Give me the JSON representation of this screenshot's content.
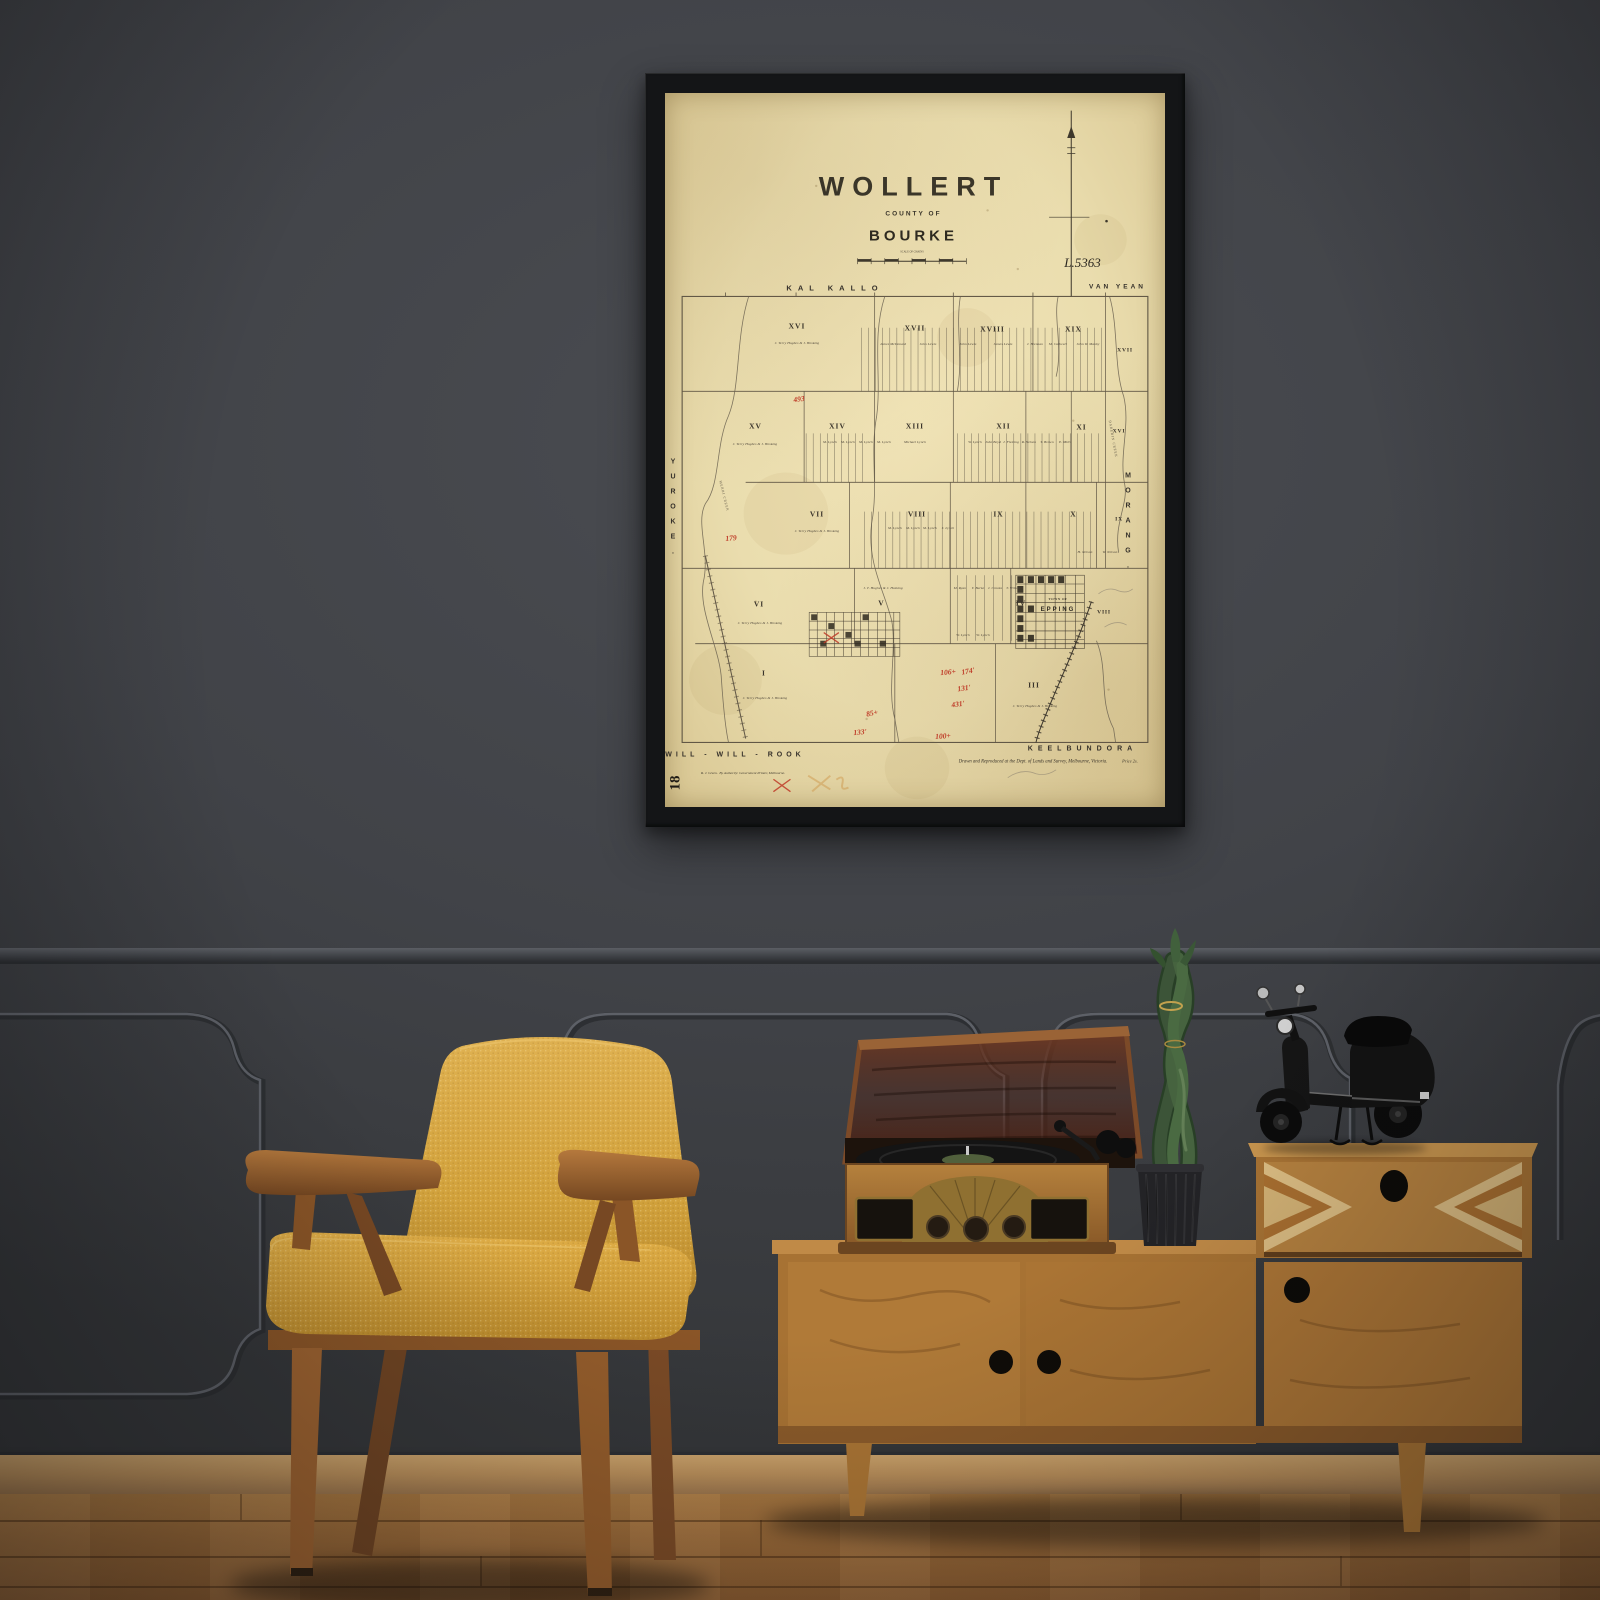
{
  "poster": {
    "title": "WOLLERT",
    "subtitle": "COUNTY OF",
    "county": "BOURKE",
    "scale_caption": "SCALE OF CHAINS",
    "plan_number": "L.5363",
    "corner_mark": "18",
    "credit": "Drawn and Reproduced at the Dept. of Lands and Survey, Melbourne, Victoria.",
    "price": "Price 2s.",
    "printer_name": "R. J. Green.",
    "printer_note": "By Authority: Government Printer, Melbourne.",
    "borders": {
      "top_left": "KAL KALLO",
      "top_right": "VAN YEAN",
      "left": "YUROKE.",
      "right": "MORANG.",
      "bottom_left": "WILL - WILL - ROOK",
      "bottom_right": "KEELBUNDORA"
    },
    "town": {
      "prefix": "TOWN OF",
      "name": "EPPING"
    },
    "sections": [
      {
        "label": "XVI",
        "x": 26.4,
        "y": 32.6
      },
      {
        "label": "XVII",
        "x": 50,
        "y": 32.9
      },
      {
        "label": "XVIII",
        "x": 65.5,
        "y": 33
      },
      {
        "label": "XIX",
        "x": 81.7,
        "y": 33
      },
      {
        "label": "XVII",
        "x": 91.9,
        "y": 36,
        "edge": true
      },
      {
        "label": "XV",
        "x": 18.1,
        "y": 46.6
      },
      {
        "label": "XIV",
        "x": 34.5,
        "y": 46.6
      },
      {
        "label": "XIII",
        "x": 50,
        "y": 46.6
      },
      {
        "label": "XII",
        "x": 67.7,
        "y": 46.6
      },
      {
        "label": "XI",
        "x": 83.3,
        "y": 46.8
      },
      {
        "label": "XVI",
        "x": 90.7,
        "y": 47.4,
        "edge": true
      },
      {
        "label": "VII",
        "x": 30.4,
        "y": 58.9
      },
      {
        "label": "VIII",
        "x": 50.4,
        "y": 58.9
      },
      {
        "label": "IX",
        "x": 66.7,
        "y": 59
      },
      {
        "label": "X",
        "x": 81.7,
        "y": 58.9
      },
      {
        "label": "IX",
        "x": 90.7,
        "y": 59.7,
        "edge": true
      },
      {
        "label": "VI",
        "x": 18.8,
        "y": 71.6
      },
      {
        "label": "V",
        "x": 43.3,
        "y": 71.4
      },
      {
        "label": "IV",
        "x": 71.2,
        "y": 71.4
      },
      {
        "label": "VIII",
        "x": 87.7,
        "y": 72.7,
        "edge": true
      },
      {
        "label": "I",
        "x": 19.8,
        "y": 81.2
      },
      {
        "label": "III",
        "x": 73.8,
        "y": 82.9
      }
    ],
    "landholders": [
      {
        "name": "J. Terry Hughes & J. Hosking",
        "x": 26.4,
        "y": 35.0
      },
      {
        "name": "James McDonald",
        "x": 45.5,
        "y": 35.2
      },
      {
        "name": "John Lewis",
        "x": 52.5,
        "y": 35.2
      },
      {
        "name": "John Lewis",
        "x": 60.5,
        "y": 35.2
      },
      {
        "name": "James Lewis",
        "x": 67.5,
        "y": 35.2
      },
      {
        "name": "J. Brennan",
        "x": 74.0,
        "y": 35.2
      },
      {
        "name": "M. Cathcart",
        "x": 78.5,
        "y": 35.2
      },
      {
        "name": "John W. Manby",
        "x": 84.5,
        "y": 35.2
      },
      {
        "name": "J. Terry Hughes & J. Hosking",
        "x": 18.0,
        "y": 49.2
      },
      {
        "name": "M. Lynch",
        "x": 33.0,
        "y": 48.9
      },
      {
        "name": "M. Lynch",
        "x": 36.6,
        "y": 48.9
      },
      {
        "name": "M. Lynch",
        "x": 40.2,
        "y": 48.9
      },
      {
        "name": "M. Lynch",
        "x": 43.8,
        "y": 48.9
      },
      {
        "name": "Michael Lynch",
        "x": 50.0,
        "y": 48.9
      },
      {
        "name": "W. Lynch",
        "x": 62.0,
        "y": 48.9
      },
      {
        "name": "John Boyd",
        "x": 65.6,
        "y": 48.9
      },
      {
        "name": "J. Fleming",
        "x": 69.2,
        "y": 48.9
      },
      {
        "name": "R. Nelson",
        "x": 72.8,
        "y": 48.9
      },
      {
        "name": "T. Brown",
        "x": 76.4,
        "y": 48.9
      },
      {
        "name": "E. Mills",
        "x": 80.0,
        "y": 48.9
      },
      {
        "name": "J. Terry Hughes & J. Hosking",
        "x": 30.3,
        "y": 61.4
      },
      {
        "name": "M. Lynch",
        "x": 46.0,
        "y": 60.9
      },
      {
        "name": "M. Lynch",
        "x": 49.5,
        "y": 60.9
      },
      {
        "name": "M. Lynch",
        "x": 53.0,
        "y": 60.9
      },
      {
        "name": "J. Lynch",
        "x": 56.5,
        "y": 60.9
      },
      {
        "name": "H. Nelson",
        "x": 84.0,
        "y": 64.3
      },
      {
        "name": "W. Nelson",
        "x": 89.0,
        "y": 64.3
      },
      {
        "name": "J. Terry Hughes & J. Hosking",
        "x": 19.0,
        "y": 74.2
      },
      {
        "name": "J. T. Hughes & J. Hosking",
        "x": 43.5,
        "y": 69.3
      },
      {
        "name": "M. Ryan",
        "x": 59.0,
        "y": 69.3
      },
      {
        "name": "T. Burke",
        "x": 62.5,
        "y": 69.3
      },
      {
        "name": "J. Crooks",
        "x": 66.0,
        "y": 69.3
      },
      {
        "name": "T. Wilson",
        "x": 69.5,
        "y": 69.3
      },
      {
        "name": "W. Lynch",
        "x": 59.5,
        "y": 75.9
      },
      {
        "name": "W. Lynch",
        "x": 63.5,
        "y": 75.9
      },
      {
        "name": "J. Terry Hughes & J. Hosking",
        "x": 20.0,
        "y": 84.8
      },
      {
        "name": "J. Terry Hughes & J. Hosking",
        "x": 74.0,
        "y": 85.8
      }
    ],
    "red_annotations": [
      {
        "text": "493",
        "x": 26.8,
        "y": 42.9,
        "rot": -8
      },
      {
        "text": "179",
        "x": 13.1,
        "y": 62.3,
        "rot": -5
      },
      {
        "text": "106+",
        "x": 56.5,
        "y": 81.1,
        "rot": -5
      },
      {
        "text": "174'",
        "x": 60.5,
        "y": 81.0,
        "rot": -10
      },
      {
        "text": "131'",
        "x": 59.7,
        "y": 83.3,
        "rot": -8
      },
      {
        "text": "431'",
        "x": 58.5,
        "y": 85.6,
        "rot": -8
      },
      {
        "text": "85+",
        "x": 41.3,
        "y": 86.8,
        "rot": -12
      },
      {
        "text": "133'",
        "x": 38.9,
        "y": 89.5,
        "rot": -5
      },
      {
        "text": "100+",
        "x": 55.6,
        "y": 90.1,
        "rot": -4
      }
    ],
    "creek_labels": [
      {
        "text": "MERRI CREEK",
        "x": 11.8,
        "y": 56.5,
        "rot": 76
      },
      {
        "text": "DAREBIN CREEK",
        "x": 89.5,
        "y": 48.5,
        "rot": 80
      }
    ],
    "colors": {
      "paper": "#ecdfb2",
      "ink": "#3e382c",
      "red_ink": "#bf3b28"
    }
  },
  "room": {
    "colors": {
      "wall": "#414348",
      "molding": "#5c5f66",
      "baseboard": "#b88e5a",
      "floor": "#9c6b39",
      "frame": "#141517",
      "chair_fabric": "#d2a341",
      "chair_wood": "#8f5a2b",
      "sideboard_wood": "#ad7837",
      "record_player_lid": "#52261a",
      "plant_green": "#46633f",
      "plant_pot": "#232326",
      "scooter_black": "#111111"
    }
  }
}
